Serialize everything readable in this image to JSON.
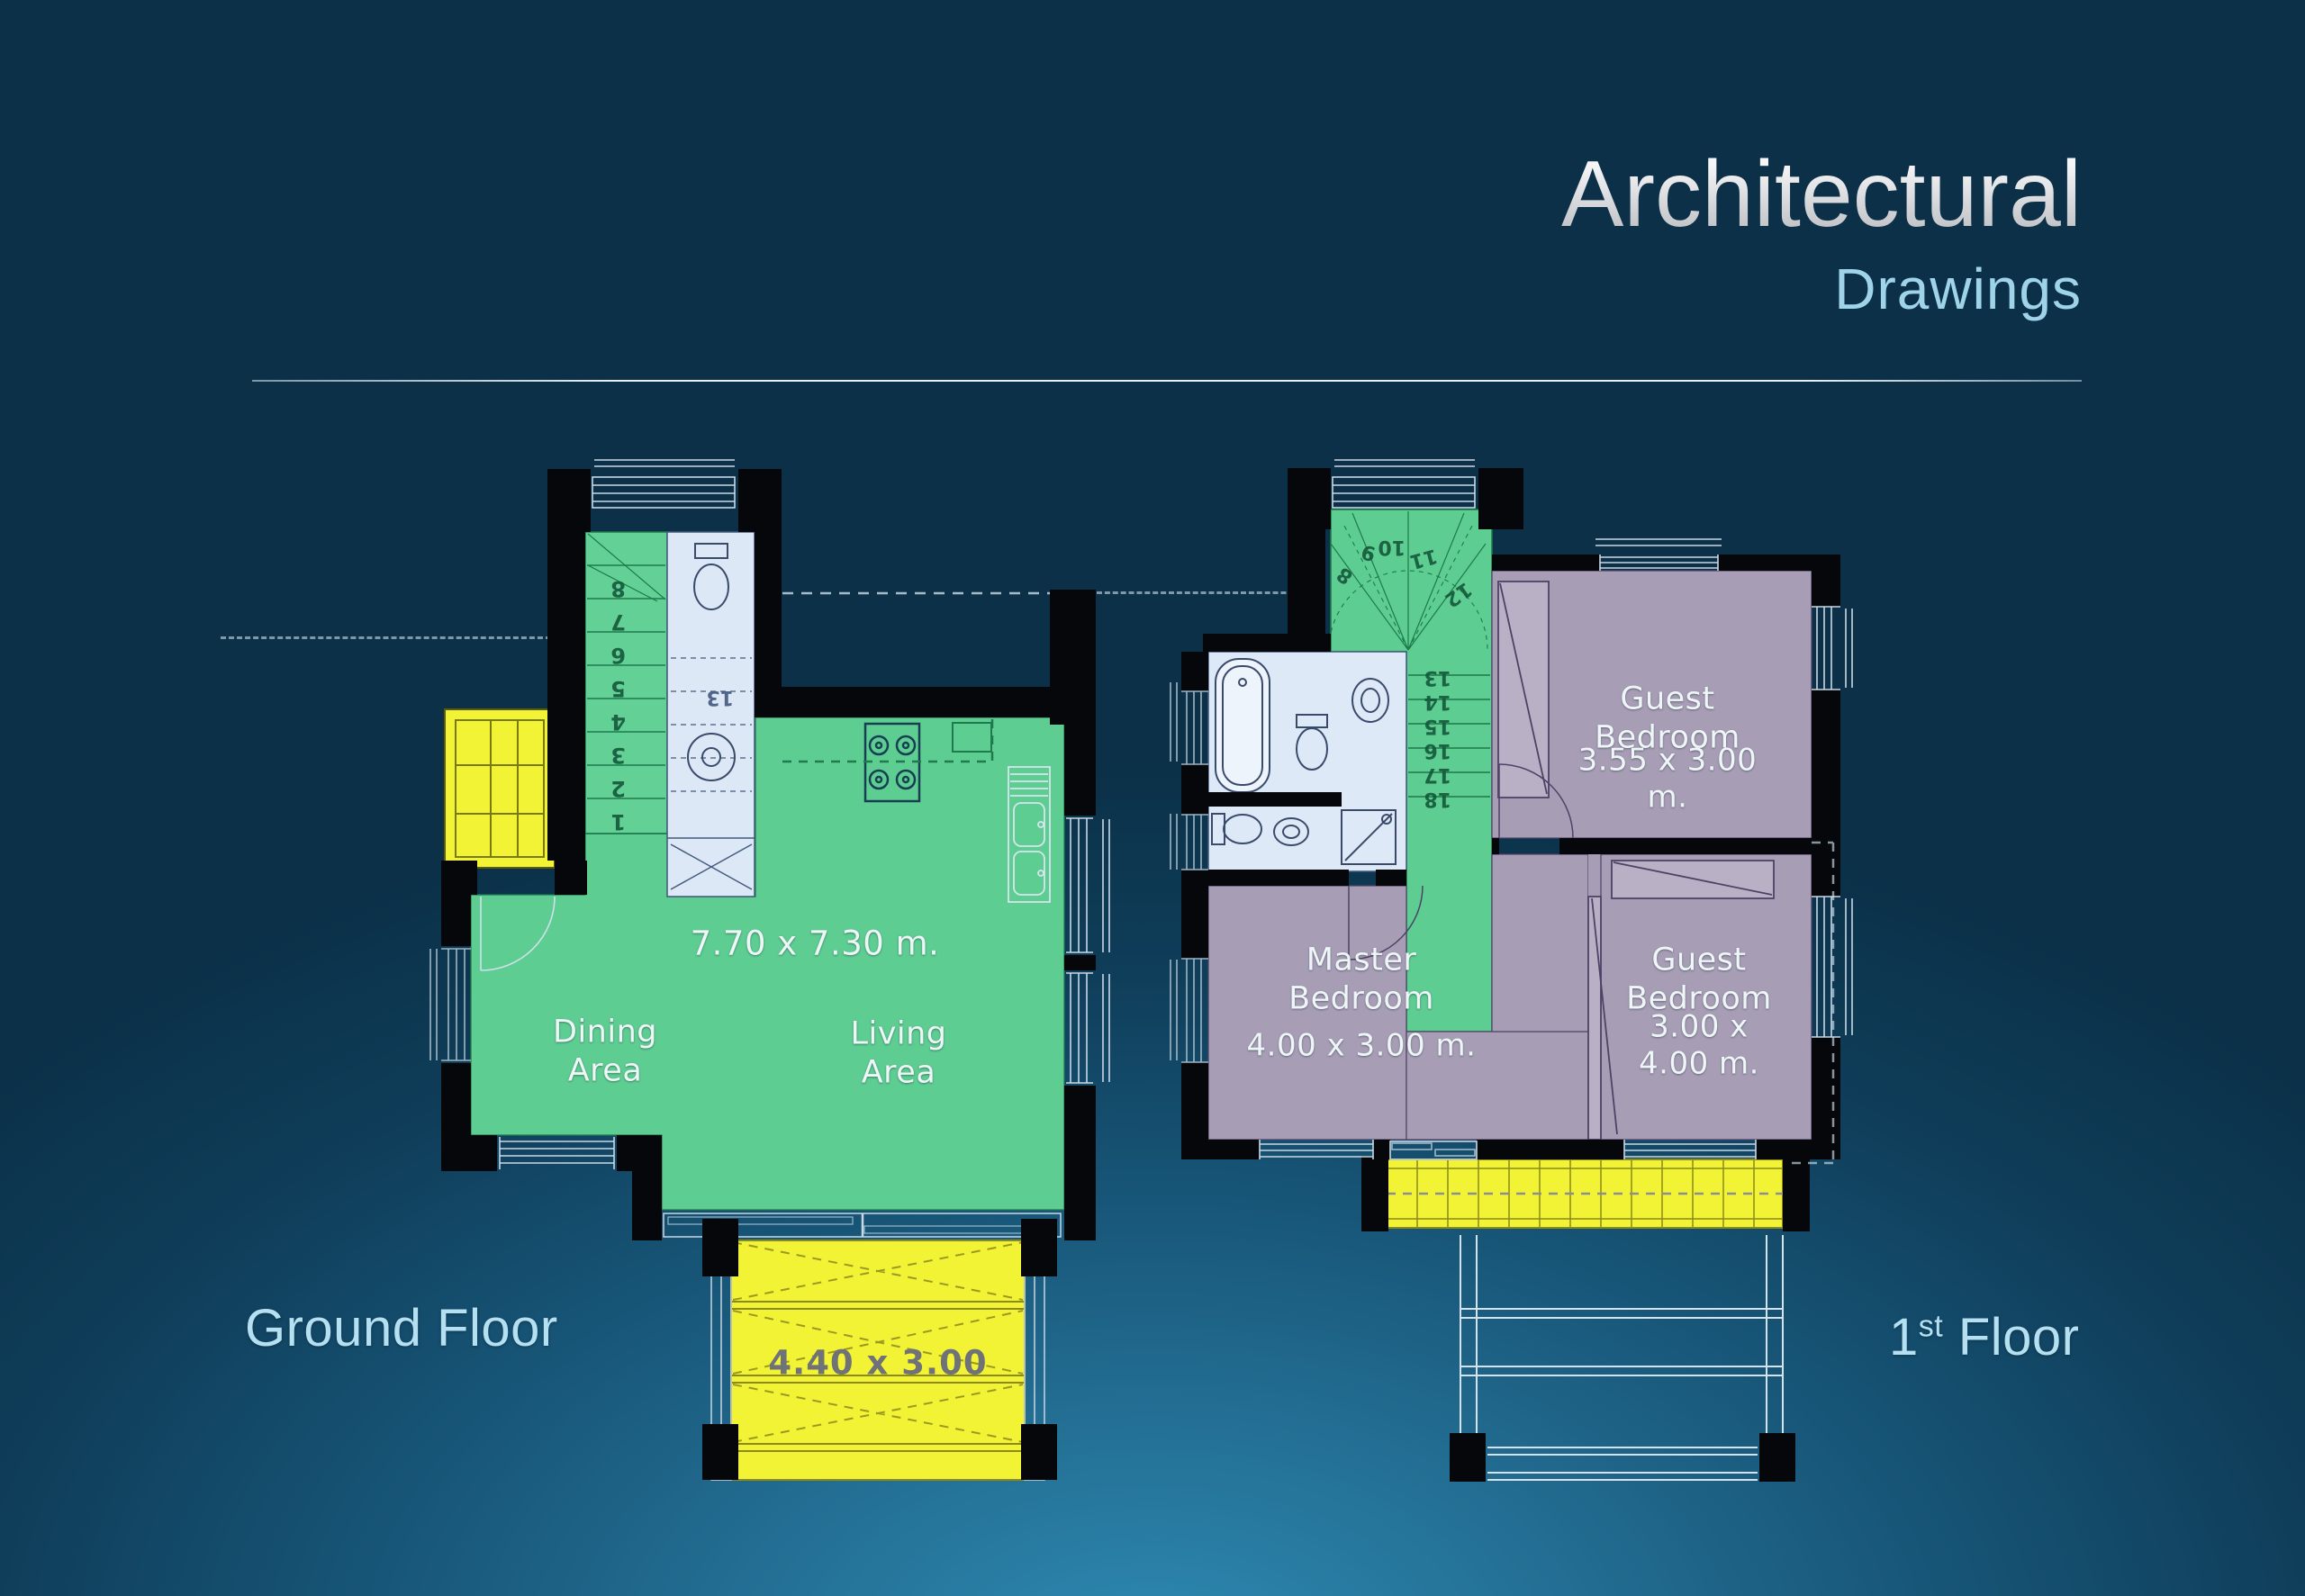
{
  "title": {
    "line1": "Architectural",
    "line2": "Drawings"
  },
  "plans": {
    "ground": {
      "label": "Ground Floor",
      "room_dim": "7.70 x 7.30 m.",
      "dining_label": "Dining\nArea",
      "living_label": "Living\nArea",
      "deck_dim": "4.40 x 3.00",
      "stairs": [
        "8",
        "7",
        "6",
        "5",
        "4",
        "3",
        "2",
        "1"
      ],
      "upper_stair": "13"
    },
    "first": {
      "label_num": "1",
      "label_sup": "st",
      "label_rest": "Floor",
      "guest1_name": "Guest\nBedroom",
      "guest1_dim": "3.55 x 3.00 m.",
      "master_name": "Master\nBedroom",
      "master_dim": "4.00 x 3.00 m.",
      "guest2_name": "Guest\nBedroom",
      "guest2_dim": "3.00 x 4.00 m.",
      "stair_fan": [
        "8",
        "9",
        "10",
        "11",
        "12"
      ],
      "stair_run": [
        "13",
        "14",
        "15",
        "16",
        "17",
        "18"
      ]
    }
  },
  "colors": {
    "floor_green": "#5ecd92",
    "deck_yellow": "#f2f335",
    "bedroom_purple": "#a79eb6",
    "bath_blue": "#dde9f6",
    "label_blue": "#b5e0f2",
    "wall_black": "#06070a"
  }
}
